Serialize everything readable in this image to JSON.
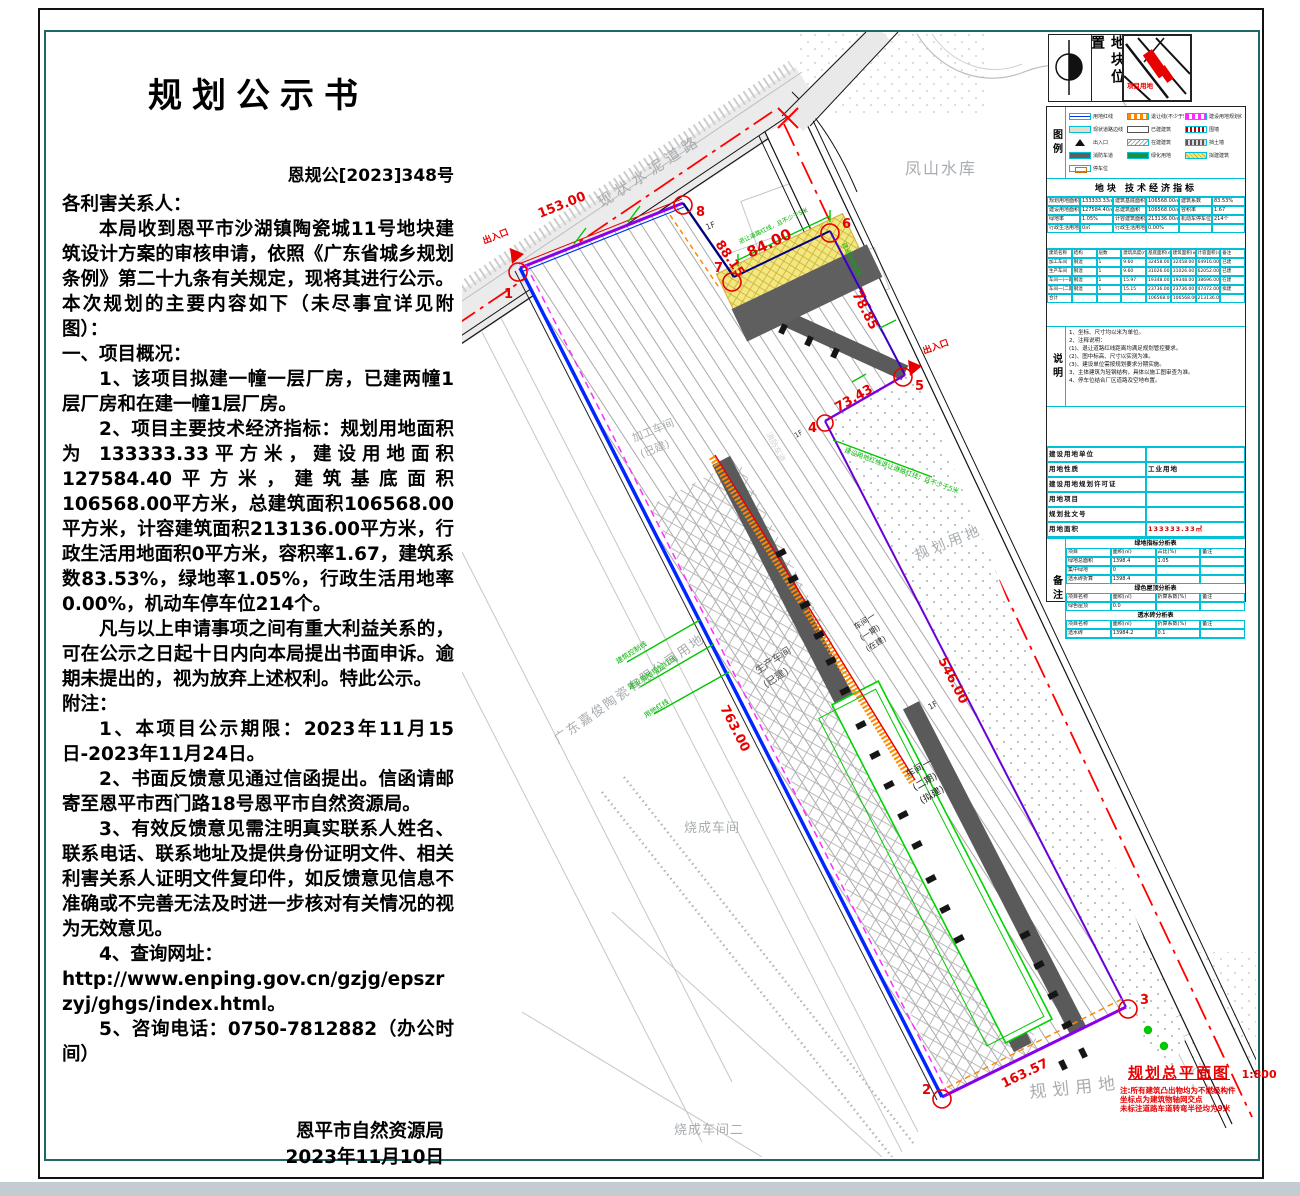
{
  "doc": {
    "title": "规划公示书",
    "doc_no": "恩规公[2023]348号",
    "salutation": "各利害关系人：",
    "p1": "本局收到恩平市沙湖镇陶瓷城11号地块建筑设计方案的审核申请，依照《广东省城乡规划条例》第二十九条有关规定，现将其进行公示。本次规划的主要内容如下（未尽事宜详见附图）：",
    "h1": "一、项目概况：",
    "p2": "1、该项目拟建一幢一层厂房，已建两幢1层厂房和在建一幢1层厂房。",
    "p3": "2、项目主要技术经济指标：规划用地面积为 133333.33平方米，建设用地面积127584.40平方米，建筑基底面积106568.00平方米，总建筑面积106568.00平方米，计容建筑面积213136.00平方米，行政生活用地面积0平方米，容积率1.67，建筑系数83.53%，绿地率1.05%，行政生活用地率0.00%，机动车停车位214个。",
    "p4": "凡与以上申请事项之间有重大利益关系的，可在公示之日起十日内向本局提出书面申诉。逾期未提出的，视为放弃上述权利。特此公示。",
    "h2": "附注：",
    "n1": "1、本项目公示期限：2023年11月15日-2023年11月24日。",
    "n2": "2、书面反馈意见通过信函提出。信函请邮寄至恩平市西门路18号恩平市自然资源局。",
    "n3": "3、有效反馈意见需注明真实联系人姓名、联系电话、联系地址及提供身份证明文件、相关利害关系人证明文件复印件，如反馈意见信息不准确或不完善无法及时进一步核对有关情况的视为无效意见。",
    "n4": "4、查询网址：",
    "n4url": "http://www.enping.gov.cn/gzjg/epszrzyj/ghgs/index.html。",
    "n5": "5、咨询电话：0750-7812882（办公时间）",
    "sig": "恩平市自然资源局",
    "date": "2023年11月10日"
  },
  "map": {
    "road_name": "现状水泥道路",
    "reservoir": "凤山水库",
    "company_land": "广东嘉俊陶瓷有限公司用地",
    "firing1": "烧成车间",
    "firing2": "烧成车间二",
    "planning_land1": "规划用地",
    "planning_land2": "规划用地",
    "wp1": "加工车间",
    "wp2": "(已建)",
    "pr1": "生产车间",
    "pr2": "(已建)",
    "w1a": "车间一",
    "w1b": "(一期)",
    "w1c": "(在建)",
    "w2a": "车间一",
    "w2b": "(二期)",
    "w2c": "(拟建)",
    "fire_lane": "消防车道",
    "entrance1": "出入口",
    "entrance2": "出入口",
    "floor1": "1F",
    "floor2": "1F",
    "floor3": "1F",
    "dims": {
      "d153": "153.00",
      "d8815": "88.15",
      "d84": "84.00",
      "d7885": "78.85",
      "d7343": "73.43",
      "d763": "763.00",
      "d546": "546.00",
      "d16357": "163.57"
    },
    "points": {
      "p1": "1",
      "p2": "2",
      "p3": "3",
      "p4": "4",
      "p5": "5",
      "p6": "6",
      "p7": "7",
      "p8": "8"
    },
    "green": {
      "g1": "建筑控制线",
      "g2": "建设用地规划红线",
      "g3": "用地红线",
      "g4": "建设用地红线退让道路红线，且不少于5米",
      "g5": "退让道路红线，且不少于5米",
      "g6": "建设用地红线"
    }
  },
  "panel": {
    "loc_title": "地块位置",
    "mini_label": "项目用地",
    "legend_title": "图例",
    "legend": [
      {
        "sw": "blue-line",
        "label": "用地红线"
      },
      {
        "sw": "orange-dash",
        "label": "退让线(不少于5米)"
      },
      {
        "sw": "magenta-dash",
        "label": "建设用地规划红线"
      },
      {
        "sw": "beige-line",
        "label": "现状道路边线"
      },
      {
        "sw": "white-rect",
        "label": "已建建筑"
      },
      {
        "sw": "red-band",
        "label": "围墙"
      },
      {
        "sw": "black-tri",
        "label": "出入口"
      },
      {
        "sw": "hatch-rect",
        "label": "在建建筑"
      },
      {
        "sw": "track-band",
        "label": "挡土墙"
      },
      {
        "sw": "gray-rect",
        "label": "消防车道"
      },
      {
        "sw": "green-rect",
        "label": "绿化用地"
      },
      {
        "sw": "yellow-hatch",
        "label": "拟建建筑"
      },
      {
        "sw": "orange-box",
        "label": "停车位"
      }
    ],
    "econ_title": "地块  技术经济指标",
    "econ": [
      [
        "规划用地面积",
        "133333.33㎡",
        "建筑基底面积",
        "106568.00㎡",
        "建筑系数",
        "83.53%"
      ],
      [
        "建设用地面积",
        "127584.40㎡",
        "总建筑面积",
        "106568.00㎡",
        "容积率",
        "1.67"
      ],
      [
        "绿地率",
        "1.05%",
        "计容建筑面积",
        "213136.00㎡",
        "机动车停车位",
        "214个"
      ],
      [
        "行政生活用地面积",
        "0㎡",
        "行政生活用地率",
        "0.00%",
        "",
        ""
      ]
    ],
    "bt_head": [
      [
        "建筑名称",
        "结构",
        "层数",
        "建筑高度(m)",
        "基底面积(㎡)",
        "建筑面积(㎡)",
        "计容面积(㎡)",
        "备注"
      ]
    ],
    "bt_rows": [
      [
        "加工车间",
        "钢混",
        "1",
        "9.60",
        "32458.00",
        "32458.00",
        "64916.00",
        "已建"
      ],
      [
        "生产车间",
        "钢混",
        "1",
        "9.60",
        "31026.00",
        "31026.00",
        "62052.00",
        "已建"
      ],
      [
        "车间一(一期)",
        "钢混",
        "1",
        "15.97",
        "19348.00",
        "19348.00",
        "38696.00",
        "在建"
      ],
      [
        "车间一(二期)",
        "钢混",
        "1",
        "15.15",
        "23736.00",
        "23736.00",
        "47472.00",
        "拟建"
      ],
      [
        "合计",
        "",
        "",
        "",
        "106568.00",
        "106568.00",
        "213136.00",
        ""
      ]
    ],
    "shuoming_title": "说明",
    "notes": [
      "1、坐标、尺寸均以米为单位。",
      "2、注释说明：",
      "(1)、退让道路红线距离均满足规划管控要求。",
      "(2)、图中标高、尺寸以实测为准。",
      "(3)、建设单位需按规划要求分期实施。",
      "3、主体建筑为轻钢结构，具体以施工图审查为准。",
      "4、停车位结合厂区道路及空地布置。"
    ],
    "fields": [
      [
        "建设用地单位",
        ""
      ],
      [
        "用地性质",
        "工业用地"
      ],
      [
        "建设用地规划许可证",
        ""
      ],
      [
        "用地项目",
        ""
      ],
      [
        "规划批文号",
        ""
      ],
      [
        "用地面积",
        "133333.33㎡"
      ],
      [
        "批准日期",
        ""
      ]
    ],
    "remark_title": "备注",
    "t1_title": "绿地指标分析表",
    "t1": [
      [
        "项目",
        "面积(㎡)",
        "占比(%)",
        "备注"
      ],
      [
        "绿地总面积",
        "1398.4",
        "1.05",
        ""
      ],
      [
        "集中绿地",
        "0",
        "",
        ""
      ],
      [
        "透水砖折算",
        "1398.4",
        "",
        ""
      ]
    ],
    "t2_title": "绿色屋顶分析表",
    "t2": [
      [
        "项目名称",
        "面积(㎡)",
        "折算系数(%)",
        "备注"
      ],
      [
        "绿色屋顶",
        "0.0",
        "",
        ""
      ]
    ],
    "t3_title": "透水砖分析表",
    "t3": [
      [
        "项目名称",
        "面积(㎡)",
        "折算系数(%)",
        "备注"
      ],
      [
        "透水砖",
        "13984.2",
        "0.1",
        ""
      ],
      [
        "折算绿地",
        "1398.4",
        "",
        ""
      ]
    ],
    "plan_title": "规划总平面图",
    "plan_scale": "1:800",
    "plan_notes": [
      "注:所有建筑凸出物均为不燃级构件",
      "坐标点为建筑物轴网交点",
      "未标注道路车道转弯半径均为9米"
    ]
  }
}
